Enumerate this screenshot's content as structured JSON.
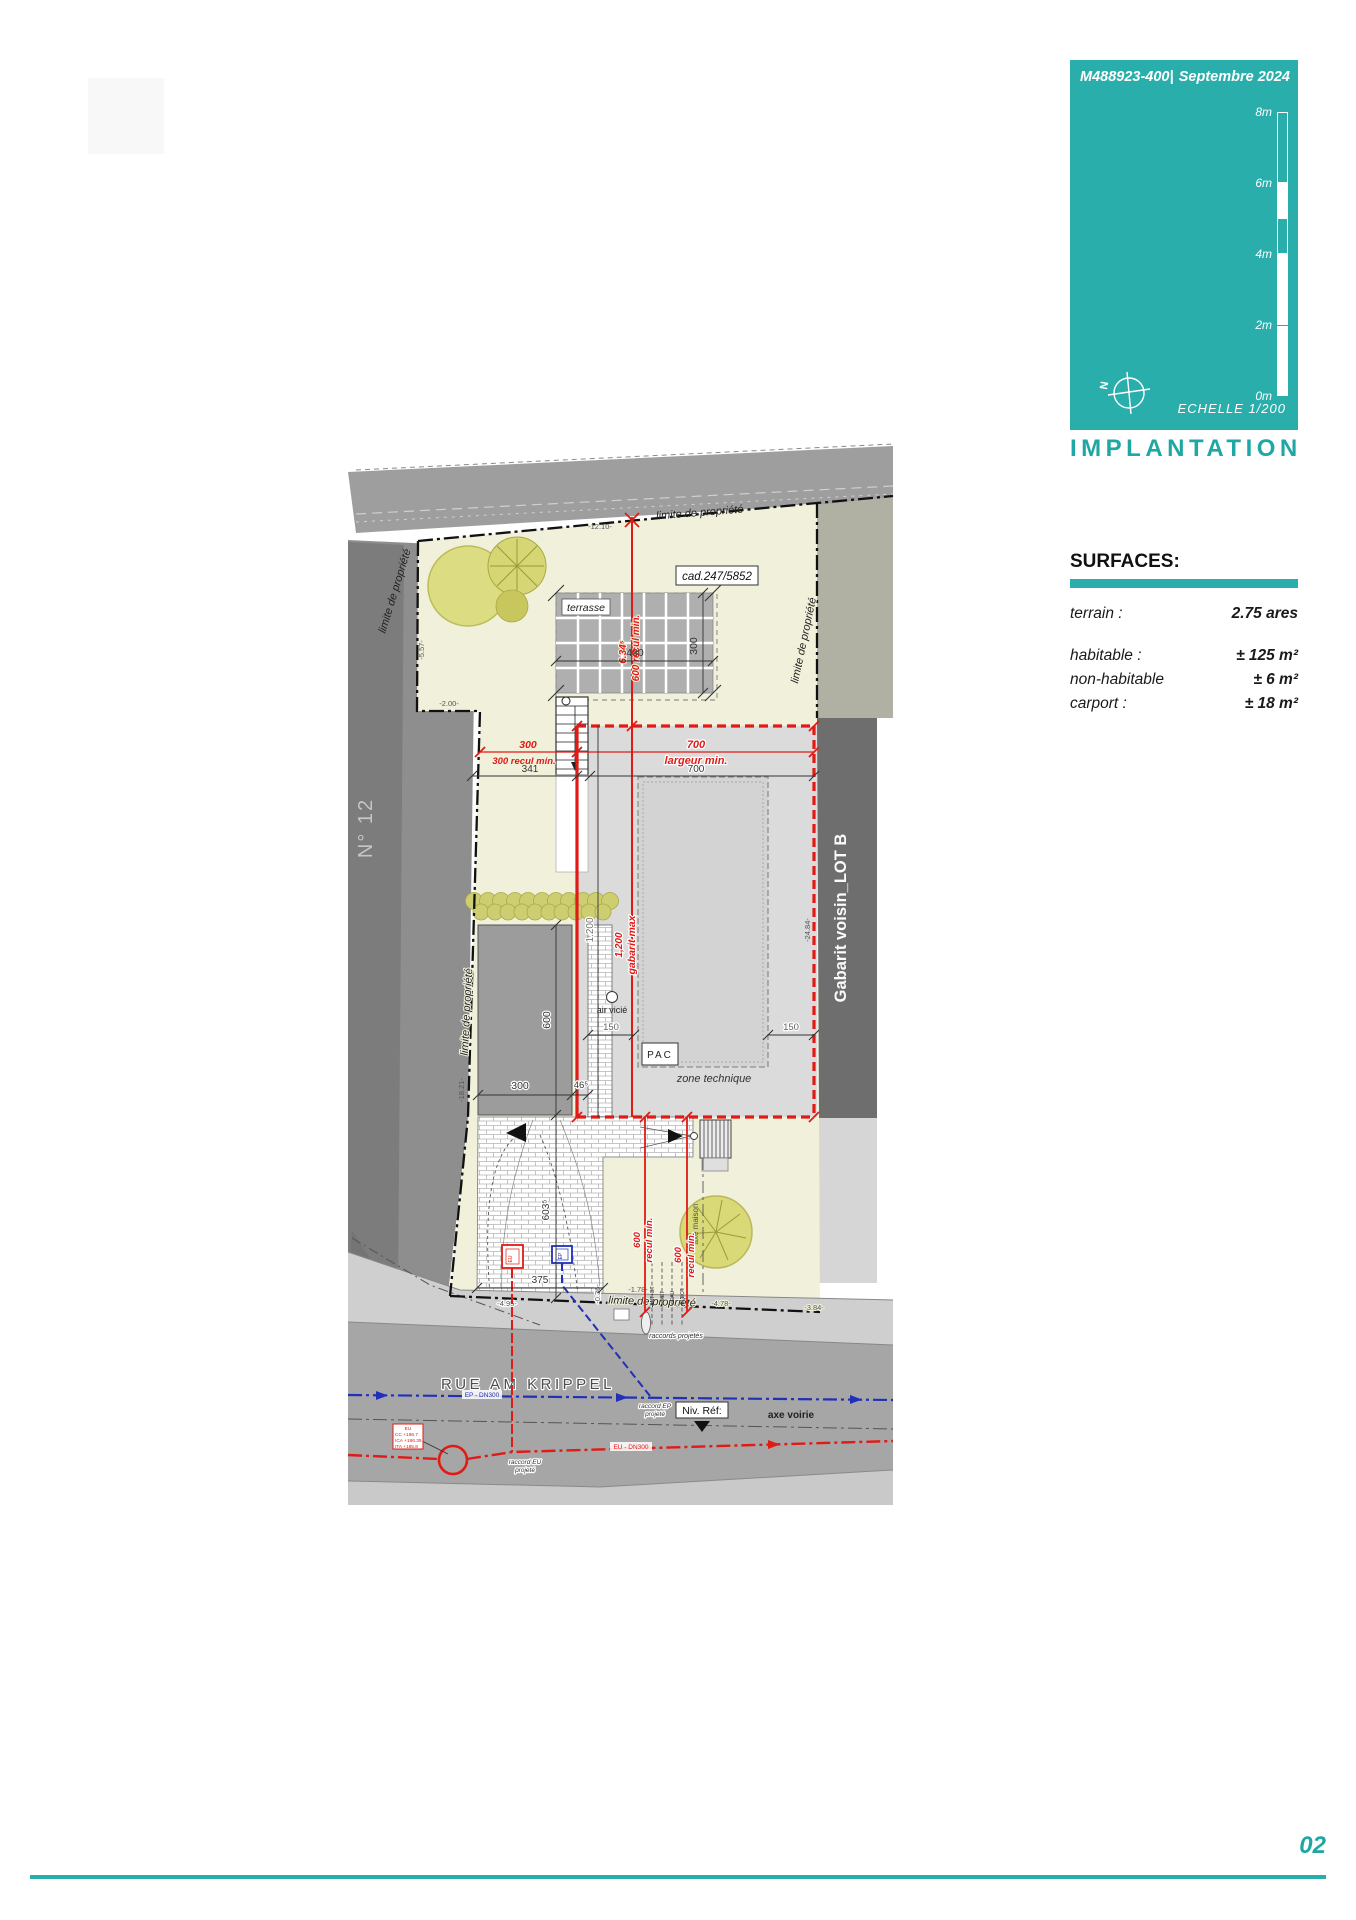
{
  "colors": {
    "teal": "#29aeab",
    "red": "#e01a15",
    "blue": "#2030b8",
    "parcel": "#f0f0db"
  },
  "page": {
    "page_number": "02"
  },
  "header": {
    "ref": "M488923-400|",
    "date": "Septembre 2024",
    "scale_labels": [
      "8m",
      "6m",
      "4m",
      "2m",
      "0m"
    ],
    "north": "N",
    "echelle": "ECHELLE  1/200",
    "title": "IMPLANTATION"
  },
  "surfaces": {
    "heading": "SURFACES:",
    "rows": [
      {
        "label": "terrain :",
        "value": "2.75 ares"
      },
      {
        "label": "habitable :",
        "value": "± 125 m²"
      },
      {
        "label": "non-habitable",
        "value": "± 6 m²"
      },
      {
        "label": "carport :",
        "value": "± 18 m²"
      }
    ]
  },
  "plan": {
    "labels": {
      "limite": "limite de propriété",
      "cadastre": "cad.247/5852",
      "terrasse": "terrasse",
      "no12": "N° 12",
      "gabarit_voisin": "Gabarit voisin_LOT B",
      "air_vicie": "air vicié",
      "pac": "PAC",
      "zone_technique": "zone technique",
      "axe_maison": "axe maison",
      "street": "RUE AM KRIPPEL",
      "niv_ref": "Niv. Réf:",
      "axe_voirie": "axe voirie",
      "raccords_projetes": "raccords projetés",
      "raccord_ep_1": "raccord EP",
      "raccord_ep_2": "projeté",
      "raccord_eu_1": "raccord EU",
      "raccord_eu_2": "projeté",
      "ep_line": "EP - DN300",
      "eu_line": "EU - DN300",
      "ut1": "ANT+BT",
      "ut2": "MET",
      "ut3": "EAU",
      "ut4": "ELECT.",
      "riser_eu": "EU",
      "riser_ep": "EP",
      "eu_note_1": "EU",
      "eu_note_2": "CC +186.7",
      "eu_note_3": "ICA +186.35",
      "eu_note_4": "ITA +185.8"
    },
    "dims": {
      "terrasse_w": "480",
      "terrasse_h": "300",
      "largeur_red": "700",
      "largeur_min": "largeur min.",
      "largeur_black": "700",
      "recul_left_red": "300",
      "recul_left_min": "300 recul min.",
      "recul_left_black": "341",
      "recul_top_val": "6.34⁵",
      "recul_top_min": "600 recul min.",
      "gab_gray": "1.200",
      "gab_red": "1,200",
      "gab_red_label": "gabarit max",
      "carport_h": "600",
      "carport_w": "300",
      "gap": "46⁵",
      "t150_left": "150",
      "t150_right": "150",
      "drive_len": "603⁵",
      "drive_w": "375",
      "recul_b1_val": "600",
      "recul_b1_label": "recul min.",
      "recul_b2_val": "600",
      "recul_b2_label": "recul min."
    },
    "elevations": {
      "e1": "-12.10-",
      "e2": "-5.57-",
      "e3": "-2.00-",
      "e4": "-18.21-",
      "e5": "-24.84-",
      "e6": "-4.95-",
      "e7": "-0.36-",
      "e8": "-1.78-",
      "e9": "-4.78-",
      "e10": "-3.84-"
    }
  }
}
